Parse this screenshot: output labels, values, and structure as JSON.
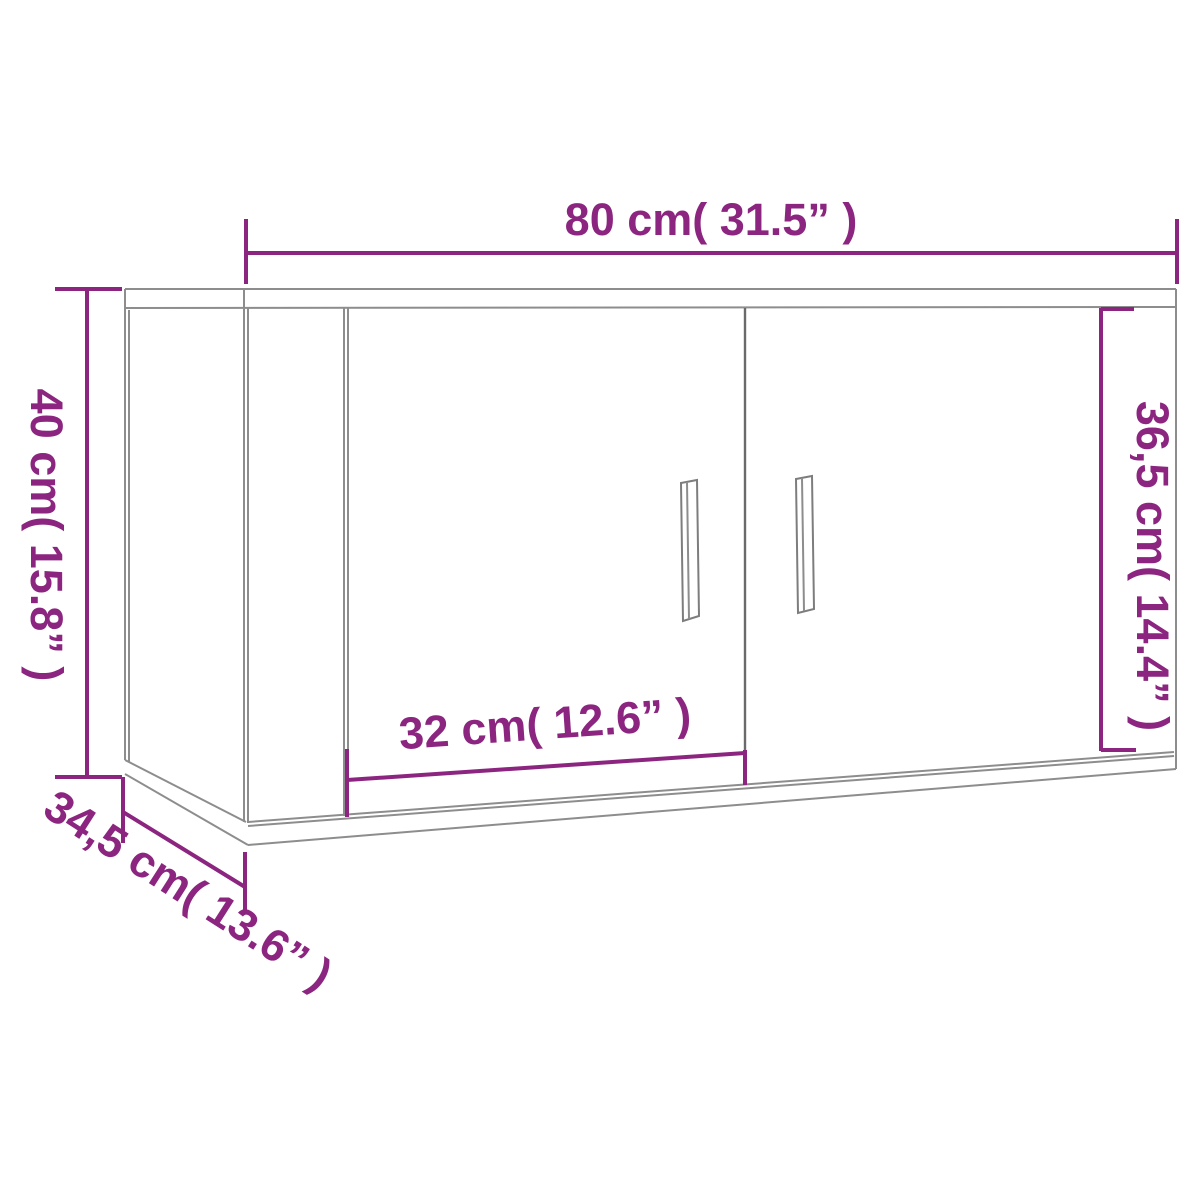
{
  "diagram": {
    "colors": {
      "dimension": "#8b2580",
      "outline": "#8d8d8d",
      "background": "#ffffff"
    },
    "dimensions": {
      "overall_width": {
        "cm": "80",
        "inches": "31.5",
        "label": "80 cm( 31.5” )"
      },
      "overall_height": {
        "cm": "40",
        "inches": "15.8",
        "label": "40 cm( 15.8” )"
      },
      "door_height": {
        "cm": "36,5",
        "inches": "14.4",
        "label": "36,5 cm( 14.4” )"
      },
      "door_width": {
        "cm": "32",
        "inches": "12.6",
        "label": "32 cm( 12.6” )"
      },
      "depth": {
        "cm": "34,5",
        "inches": "13.6",
        "label": "34,5 cm( 13.6” )"
      }
    }
  }
}
